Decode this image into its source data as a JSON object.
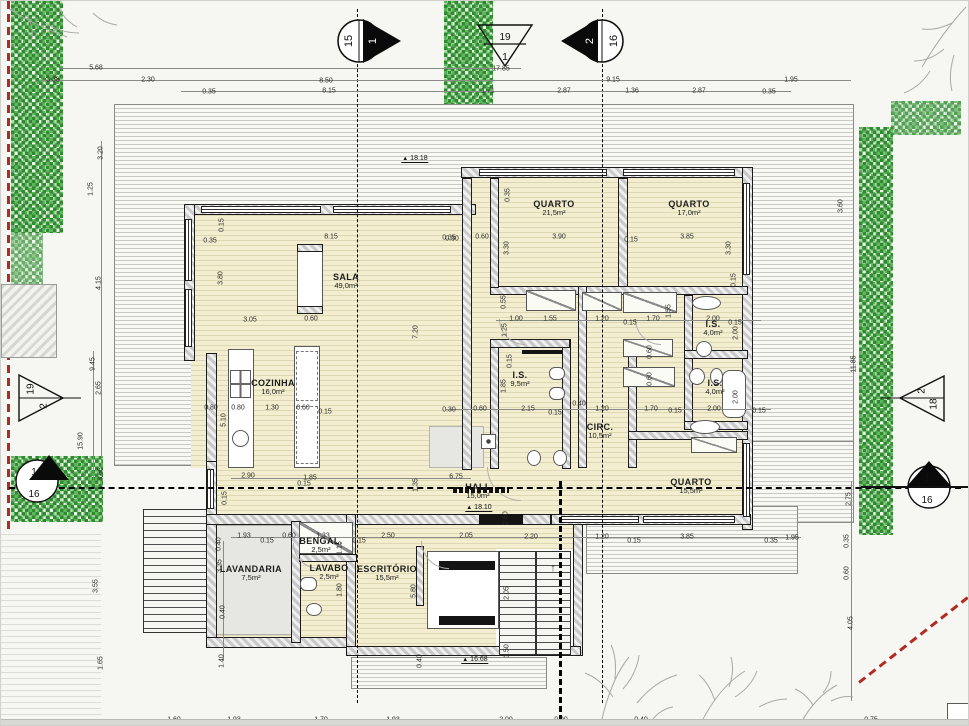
{
  "colors": {
    "floor_fill": "#f2eecf",
    "floor_line": "#ddd8b3",
    "wall_hatch": "#c9c9c9",
    "hedge_green": "#2e8b2e",
    "boundary_red": "#b22a20",
    "deck_line": "#c9c9c3"
  },
  "icons": {
    "level_marker": "▲",
    "stair_up_arrow": "↑"
  },
  "section_markers": {
    "top_left_circle": {
      "a": "15",
      "b": "1"
    },
    "top_center_triangle": {
      "a": "19",
      "b": "1"
    },
    "top_right_circle": {
      "a": "2",
      "b": "16"
    },
    "left_triangle": {
      "a": "19",
      "b": "2"
    },
    "left_circle": {
      "a": "1",
      "b": "16"
    },
    "right_triangle": {
      "a": "2",
      "b": "18"
    },
    "right_circle": {
      "a": "1",
      "b": "16"
    }
  },
  "rooms": [
    {
      "name": "SALA",
      "area": "49,0m²",
      "x": 345,
      "y": 280
    },
    {
      "name": "COZINHA",
      "area": "16,0m²",
      "x": 272,
      "y": 386
    },
    {
      "name": "QUARTO",
      "area": "21,5m²",
      "x": 553,
      "y": 207
    },
    {
      "name": "QUARTO",
      "area": "17,0m²",
      "x": 688,
      "y": 207
    },
    {
      "name": "I.S.",
      "area": "9,5m²",
      "x": 519,
      "y": 378
    },
    {
      "name": "I.S.",
      "area": "4,0m²",
      "x": 712,
      "y": 327
    },
    {
      "name": "I.S.",
      "area": "4,0m²",
      "x": 714,
      "y": 386
    },
    {
      "name": "CIRC.",
      "area": "10,5m²",
      "x": 599,
      "y": 430
    },
    {
      "name": "QUARTO",
      "area": "15,5m²",
      "x": 690,
      "y": 485
    },
    {
      "name": "HALL",
      "area": "15,0m²",
      "x": 477,
      "y": 490
    },
    {
      "name": "LAVANDARIA",
      "area": "7,5m²",
      "x": 250,
      "y": 572
    },
    {
      "name": "BENGAL.",
      "area": "2,5m²",
      "x": 320,
      "y": 544
    },
    {
      "name": "LAVABO",
      "area": "2,5m²",
      "x": 328,
      "y": 571
    },
    {
      "name": "ESCRITÓRIO",
      "area": "15,5m²",
      "x": 386,
      "y": 572
    }
  ],
  "levels": [
    {
      "value": "18.18",
      "x": 414,
      "y": 158
    },
    {
      "value": "18.10",
      "x": 478,
      "y": 507
    },
    {
      "value": "16.68",
      "x": 474,
      "y": 659
    }
  ],
  "dimensions": [
    {
      "t": "5.68",
      "x": 95,
      "y": 67
    },
    {
      "t": "17.85",
      "x": 500,
      "y": 68
    },
    {
      "t": "3.38",
      "x": 52,
      "y": 79
    },
    {
      "t": "2.30",
      "x": 147,
      "y": 79
    },
    {
      "t": "8.50",
      "x": 325,
      "y": 80
    },
    {
      "t": "9.15",
      "x": 612,
      "y": 79
    },
    {
      "t": "1.95",
      "x": 790,
      "y": 79
    },
    {
      "t": "0.35",
      "x": 208,
      "y": 91
    },
    {
      "t": "8.15",
      "x": 328,
      "y": 90
    },
    {
      "t": "1.71",
      "x": 487,
      "y": 90
    },
    {
      "t": "2.87",
      "x": 563,
      "y": 90
    },
    {
      "t": "1.36",
      "x": 631,
      "y": 90
    },
    {
      "t": "2.87",
      "x": 698,
      "y": 90
    },
    {
      "t": "0.35",
      "x": 768,
      "y": 91
    },
    {
      "t": "3.20",
      "x": 100,
      "y": 152,
      "v": 1
    },
    {
      "t": "1.25",
      "x": 90,
      "y": 188,
      "v": 1
    },
    {
      "t": "4.15",
      "x": 98,
      "y": 282,
      "v": 1
    },
    {
      "t": "9.45",
      "x": 92,
      "y": 363,
      "v": 1
    },
    {
      "t": "2.65",
      "x": 98,
      "y": 387,
      "v": 1
    },
    {
      "t": "15.90",
      "x": 80,
      "y": 440,
      "v": 1
    },
    {
      "t": "3.65",
      "x": 100,
      "y": 473,
      "v": 1
    },
    {
      "t": "3.55",
      "x": 95,
      "y": 585,
      "v": 1
    },
    {
      "t": "1.65",
      "x": 100,
      "y": 662,
      "v": 1
    },
    {
      "t": "3.60",
      "x": 840,
      "y": 205,
      "v": 1
    },
    {
      "t": "11.85",
      "x": 853,
      "y": 363,
      "v": 1
    },
    {
      "t": "2.75",
      "x": 848,
      "y": 498,
      "v": 1
    },
    {
      "t": "0.35",
      "x": 846,
      "y": 540,
      "v": 1
    },
    {
      "t": "0.60",
      "x": 846,
      "y": 572,
      "v": 1
    },
    {
      "t": "4.05",
      "x": 850,
      "y": 622,
      "v": 1
    },
    {
      "t": "0.15",
      "x": 221,
      "y": 224,
      "v": 1
    },
    {
      "t": "0.35",
      "x": 209,
      "y": 240
    },
    {
      "t": "8.15",
      "x": 330,
      "y": 236
    },
    {
      "t": "0.30",
      "x": 451,
      "y": 238
    },
    {
      "t": "3.80",
      "x": 220,
      "y": 277,
      "v": 1
    },
    {
      "t": "3.05",
      "x": 249,
      "y": 319
    },
    {
      "t": "0.60",
      "x": 310,
      "y": 318
    },
    {
      "t": "7.20",
      "x": 415,
      "y": 331,
      "v": 1
    },
    {
      "t": "0.80",
      "x": 210,
      "y": 407
    },
    {
      "t": "0.80",
      "x": 237,
      "y": 407
    },
    {
      "t": "1.30",
      "x": 271,
      "y": 407
    },
    {
      "t": "0.60",
      "x": 302,
      "y": 407
    },
    {
      "t": "0.15",
      "x": 324,
      "y": 411
    },
    {
      "t": "5.10",
      "x": 223,
      "y": 419,
      "v": 1
    },
    {
      "t": "2.90",
      "x": 247,
      "y": 475
    },
    {
      "t": "1.85",
      "x": 309,
      "y": 477
    },
    {
      "t": "0.15",
      "x": 303,
      "y": 483
    },
    {
      "t": "0.15",
      "x": 224,
      "y": 497,
      "v": 1
    },
    {
      "t": "0.35",
      "x": 507,
      "y": 194,
      "v": 1
    },
    {
      "t": "0.60",
      "x": 481,
      "y": 236
    },
    {
      "t": "3.90",
      "x": 558,
      "y": 236
    },
    {
      "t": "0.15",
      "x": 630,
      "y": 239
    },
    {
      "t": "3.85",
      "x": 686,
      "y": 236
    },
    {
      "t": "0.35",
      "x": 448,
      "y": 237
    },
    {
      "t": "3.30",
      "x": 506,
      "y": 247,
      "v": 1
    },
    {
      "t": "3.30",
      "x": 728,
      "y": 247,
      "v": 1
    },
    {
      "t": "0.15",
      "x": 733,
      "y": 279,
      "v": 1
    },
    {
      "t": "0.55",
      "x": 503,
      "y": 301,
      "v": 1
    },
    {
      "t": "1.00",
      "x": 515,
      "y": 318
    },
    {
      "t": "1.55",
      "x": 549,
      "y": 318
    },
    {
      "t": "1.20",
      "x": 601,
      "y": 318
    },
    {
      "t": "0.15",
      "x": 629,
      "y": 322
    },
    {
      "t": "1.70",
      "x": 652,
      "y": 318
    },
    {
      "t": "0.15",
      "x": 734,
      "y": 322
    },
    {
      "t": "2.00",
      "x": 712,
      "y": 318
    },
    {
      "t": "1.25",
      "x": 504,
      "y": 329,
      "v": 1
    },
    {
      "t": "0.15",
      "x": 509,
      "y": 360,
      "v": 1
    },
    {
      "t": "1.85",
      "x": 503,
      "y": 385,
      "v": 1
    },
    {
      "t": "2.00",
      "x": 735,
      "y": 332,
      "v": 1
    },
    {
      "t": "2.00",
      "x": 735,
      "y": 396,
      "v": 1
    },
    {
      "t": "0.60",
      "x": 649,
      "y": 351,
      "v": 1
    },
    {
      "t": "0.60",
      "x": 649,
      "y": 378,
      "v": 1
    },
    {
      "t": "1.55",
      "x": 668,
      "y": 310,
      "v": 1
    },
    {
      "t": "0.30",
      "x": 448,
      "y": 409
    },
    {
      "t": "0.60",
      "x": 479,
      "y": 408
    },
    {
      "t": "2.15",
      "x": 527,
      "y": 408
    },
    {
      "t": "0.15",
      "x": 554,
      "y": 412
    },
    {
      "t": "0.40",
      "x": 578,
      "y": 403
    },
    {
      "t": "1.20",
      "x": 601,
      "y": 408
    },
    {
      "t": "1.70",
      "x": 650,
      "y": 408
    },
    {
      "t": "0.15",
      "x": 674,
      "y": 410
    },
    {
      "t": "2.00",
      "x": 713,
      "y": 408
    },
    {
      "t": "0.15",
      "x": 758,
      "y": 410
    },
    {
      "t": "6.75",
      "x": 455,
      "y": 476
    },
    {
      "t": "1.35",
      "x": 415,
      "y": 484,
      "v": 1
    },
    {
      "t": "2.60",
      "x": 505,
      "y": 517,
      "v": 1
    },
    {
      "t": "0.40",
      "x": 218,
      "y": 543,
      "v": 1
    },
    {
      "t": "1.93",
      "x": 243,
      "y": 535
    },
    {
      "t": "0.15",
      "x": 266,
      "y": 540
    },
    {
      "t": "0.60",
      "x": 288,
      "y": 535
    },
    {
      "t": "1.33",
      "x": 322,
      "y": 535
    },
    {
      "t": "0.15",
      "x": 358,
      "y": 540
    },
    {
      "t": "2.50",
      "x": 387,
      "y": 535
    },
    {
      "t": "2.05",
      "x": 465,
      "y": 535
    },
    {
      "t": "2.20",
      "x": 530,
      "y": 536
    },
    {
      "t": "1.20",
      "x": 601,
      "y": 536
    },
    {
      "t": "0.15",
      "x": 633,
      "y": 540
    },
    {
      "t": "3.85",
      "x": 686,
      "y": 536
    },
    {
      "t": "0.35",
      "x": 770,
      "y": 540
    },
    {
      "t": "1.95",
      "x": 791,
      "y": 537
    },
    {
      "t": "3.35",
      "x": 219,
      "y": 565,
      "v": 1
    },
    {
      "t": "0.40",
      "x": 222,
      "y": 611,
      "v": 1
    },
    {
      "t": "1.40",
      "x": 221,
      "y": 660,
      "v": 1
    },
    {
      "t": "1.15",
      "x": 339,
      "y": 547,
      "v": 1
    },
    {
      "t": "1.80",
      "x": 339,
      "y": 589,
      "v": 1
    },
    {
      "t": "5.80",
      "x": 413,
      "y": 590,
      "v": 1
    },
    {
      "t": "0.40",
      "x": 419,
      "y": 660,
      "v": 1
    },
    {
      "t": "2.05",
      "x": 506,
      "y": 592,
      "v": 1
    },
    {
      "t": "1.50",
      "x": 506,
      "y": 650,
      "v": 1
    },
    {
      "t": "1.60",
      "x": 173,
      "y": 719
    },
    {
      "t": "1.93",
      "x": 233,
      "y": 719
    },
    {
      "t": "1.70",
      "x": 320,
      "y": 719
    },
    {
      "t": "1.93",
      "x": 392,
      "y": 719
    },
    {
      "t": "2.00",
      "x": 505,
      "y": 719
    },
    {
      "t": "0.90",
      "x": 560,
      "y": 719
    },
    {
      "t": "0.40",
      "x": 640,
      "y": 719
    },
    {
      "t": "0.75",
      "x": 870,
      "y": 719
    }
  ]
}
